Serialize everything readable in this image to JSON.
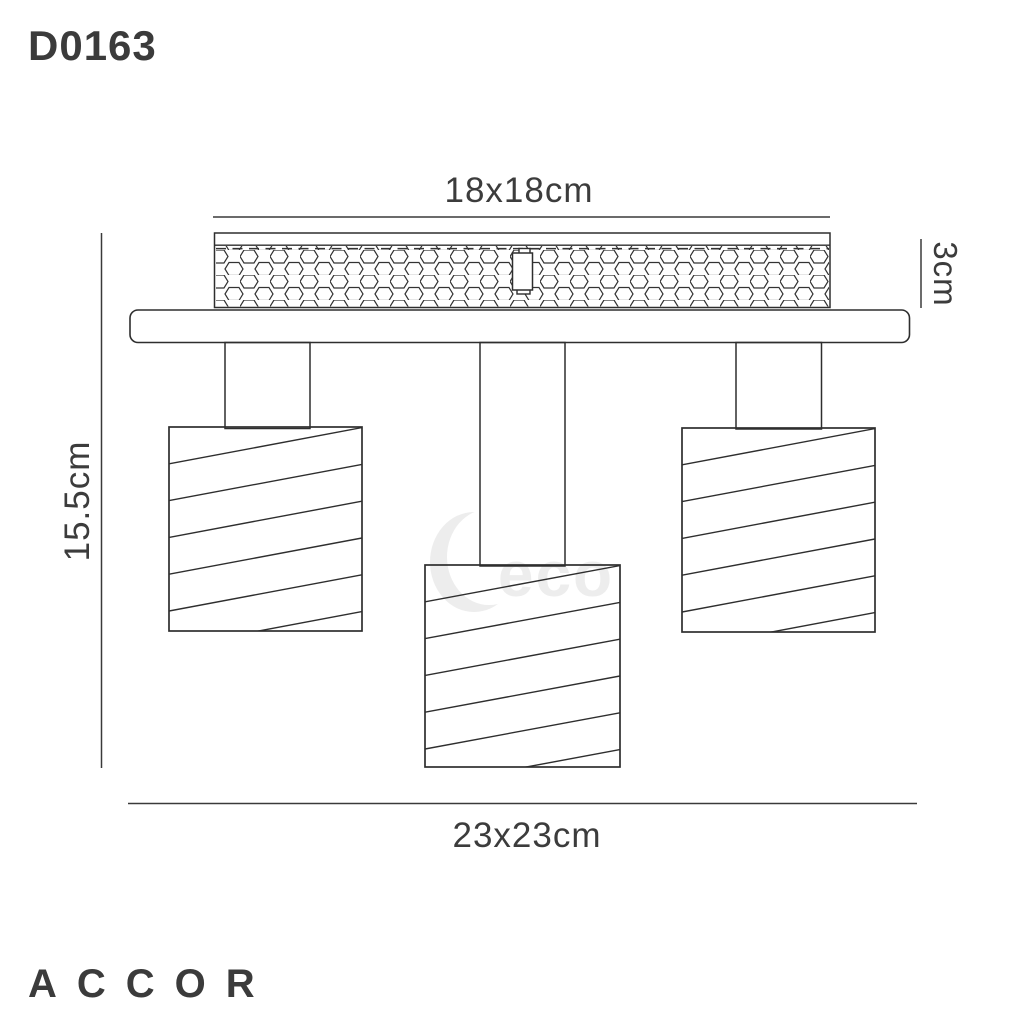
{
  "product": {
    "code": "D0163",
    "brand": "ACCOR"
  },
  "dimensions": {
    "canopy_width": "18x18cm",
    "canopy_depth": "3cm",
    "fixture_height": "15.5cm",
    "overall_width": "23x23cm"
  },
  "watermark": {
    "glyph": "crescent-d",
    "text": "eco"
  },
  "colors": {
    "drawing_line": "#2e2e2e",
    "dimension_line": "#3a3a3a",
    "label_text": "#3c3c3c",
    "watermark": "#ededed",
    "background": "#ffffff"
  }
}
